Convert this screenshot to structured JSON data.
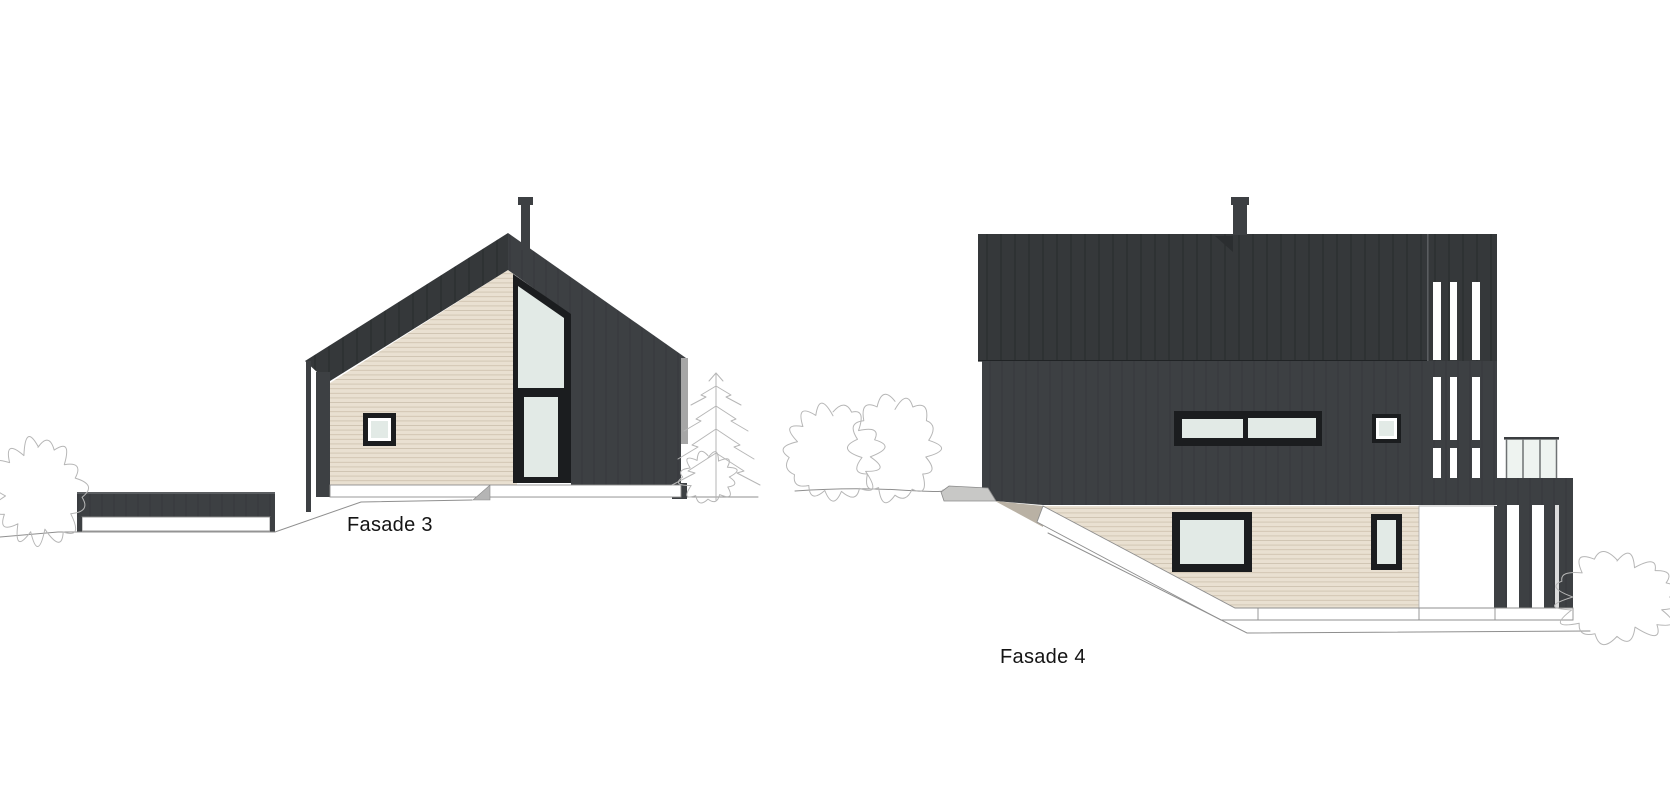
{
  "sheet": {
    "width": 1670,
    "height": 800,
    "background": "#ffffff"
  },
  "drawings": [
    {
      "id": "fasade3",
      "label": "Fasade 3"
    },
    {
      "id": "fasade4",
      "label": "Fasade 4"
    }
  ],
  "colors": {
    "clad": "#3d4043",
    "roof": "#35383a",
    "frame": "#1b1d1f",
    "beige": "#e9e0d1",
    "glass": "#e2eae6",
    "glass_bright": "#eef3f0",
    "white": "#ffffff",
    "outline": "#8f8f8f",
    "sketch": "#b6b6b6",
    "wedge": "#b9b1a4",
    "stone": "#c8c8c6",
    "fascia_gray": "#a6a6a6",
    "text": "#141414"
  }
}
